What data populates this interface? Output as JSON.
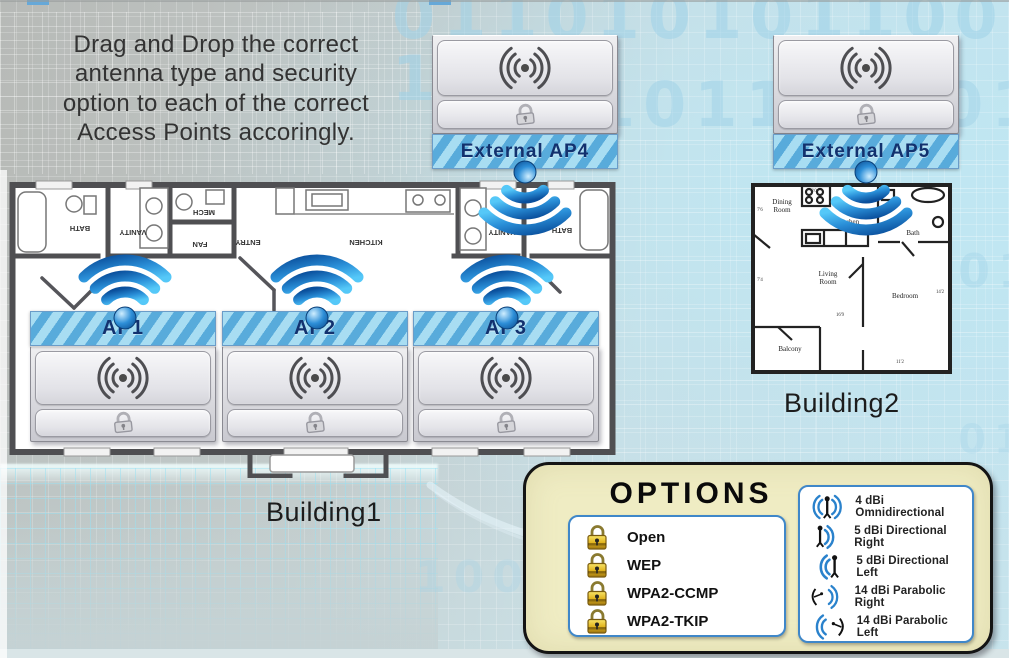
{
  "instructions": {
    "lines": [
      "Drag and Drop the correct",
      "antenna type and security",
      "option to each of the correct",
      "Access Points accoringly."
    ]
  },
  "access_points": {
    "ap1": "AP1",
    "ap2": "AP2",
    "ap3": "AP3",
    "ap4": "External AP4",
    "ap5": "External AP5"
  },
  "buildings": {
    "building1": "Building1",
    "building2": "Building2"
  },
  "building1": {
    "rooms": [
      "BATH",
      "VANITY",
      "MECH",
      "FAN",
      "ENTRY",
      "KITCHEN",
      "VANITY",
      "BATH"
    ]
  },
  "building2": {
    "rooms": {
      "dining": [
        "Dining",
        "Room"
      ],
      "kitchen": "Kitchen",
      "bath": "Bath",
      "living": [
        "Living",
        "Room"
      ],
      "bedroom": "Bedroom",
      "balcony": "Balcony"
    },
    "dimensions": [
      "8'0",
      "7'6",
      "7'4",
      "16'9",
      "14'2",
      "11'2"
    ]
  },
  "options_panel": {
    "title": "OPTIONS",
    "security_options": [
      "Open",
      "WEP",
      "WPA2-CCMP",
      "WPA2-TKIP"
    ],
    "antenna_options": [
      "4 dBi Omnidirectional",
      "5 dBi Directional Right",
      "5 dBi Directional Left",
      "14 dBi Parabolic Right",
      "14 dBi Parabolic Left"
    ]
  },
  "background_binary": [
    "0110101011001 1",
    "1011",
    "1001 1",
    "1011",
    "1001",
    "011"
  ],
  "colors": {
    "banner_blue_light": "#a8ddf2",
    "banner_blue_dark": "#58abdb",
    "banner_text_navy": "#12316e",
    "wifi_blue": "#1a78c8",
    "options_cream": "#efecc3",
    "panel_border_blue": "#3f87c9",
    "gold_lock": "#d9a916",
    "floorplan_wall": "#4f4f52"
  },
  "icons": {
    "wifi_signal": "wifi-signal-icon",
    "wireless_drop_zone": "wireless-signal-icon",
    "security_drop_zone": "padlock-outline-icon",
    "security_option": "gold-padlock-icon",
    "omnidirectional": "omnidirectional-antenna-icon",
    "directional": "directional-antenna-icon",
    "parabolic": "parabolic-dish-icon"
  }
}
